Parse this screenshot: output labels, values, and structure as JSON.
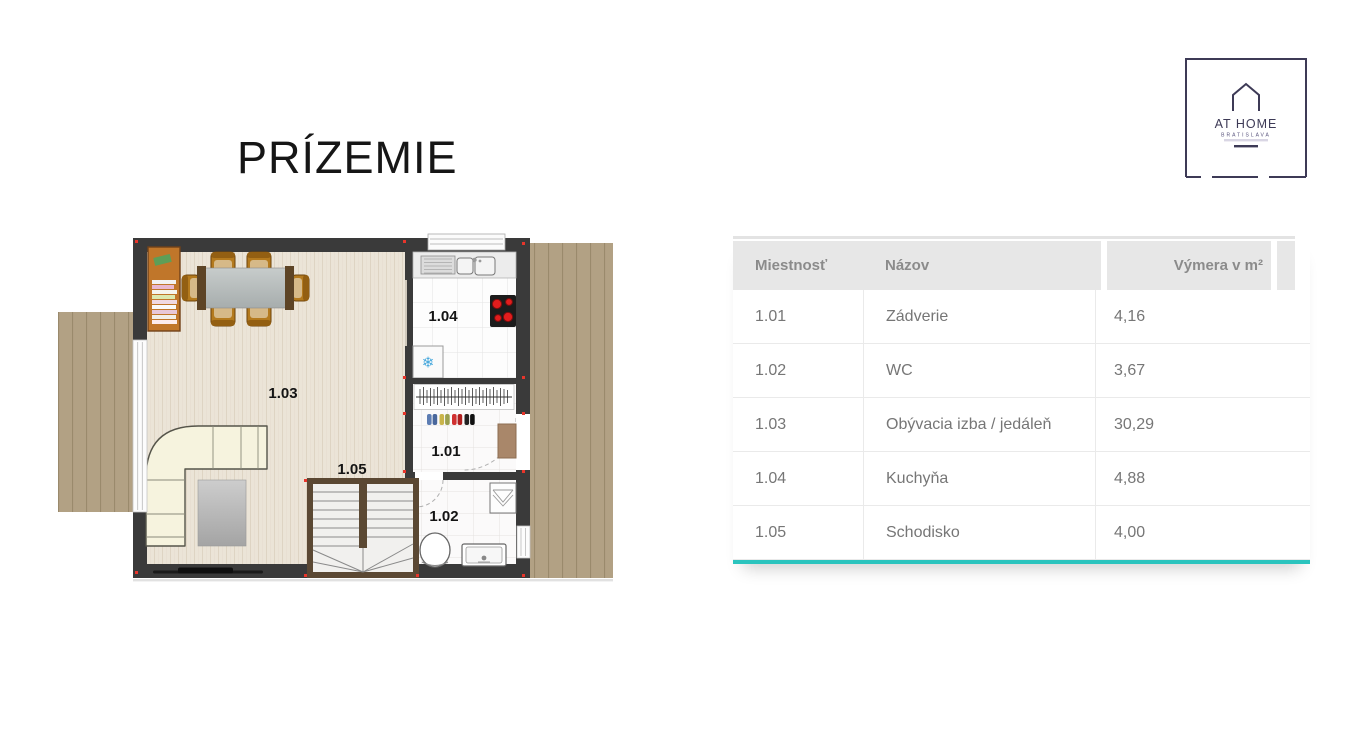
{
  "page": {
    "title": "PRÍZEMIE"
  },
  "logo": {
    "name": "AT HOME",
    "city": "BRATISLAVA",
    "accent": "#3d3a56"
  },
  "floorplan": {
    "rooms": [
      {
        "code": "1.01"
      },
      {
        "code": "1.02"
      },
      {
        "code": "1.03"
      },
      {
        "code": "1.04"
      },
      {
        "code": "1.05"
      }
    ],
    "colors": {
      "wall": "#3a3a3a",
      "terrace": "#b2a184",
      "marker": "#e8352b"
    }
  },
  "table": {
    "columns": [
      "Miestnosť",
      "Názov",
      "Výmera v m²"
    ],
    "rows": [
      {
        "code": "1.01",
        "name": "Zádverie",
        "area": "4,16"
      },
      {
        "code": "1.02",
        "name": "WC",
        "area": "3,67"
      },
      {
        "code": "1.03",
        "name": "Obývacia izba / jedáleň",
        "area": "30,29"
      },
      {
        "code": "1.04",
        "name": "Kuchyňa",
        "area": "4,88"
      },
      {
        "code": "1.05",
        "name": "Schodisko",
        "area": "4,00"
      }
    ],
    "accent_color": "#2bc4be"
  }
}
